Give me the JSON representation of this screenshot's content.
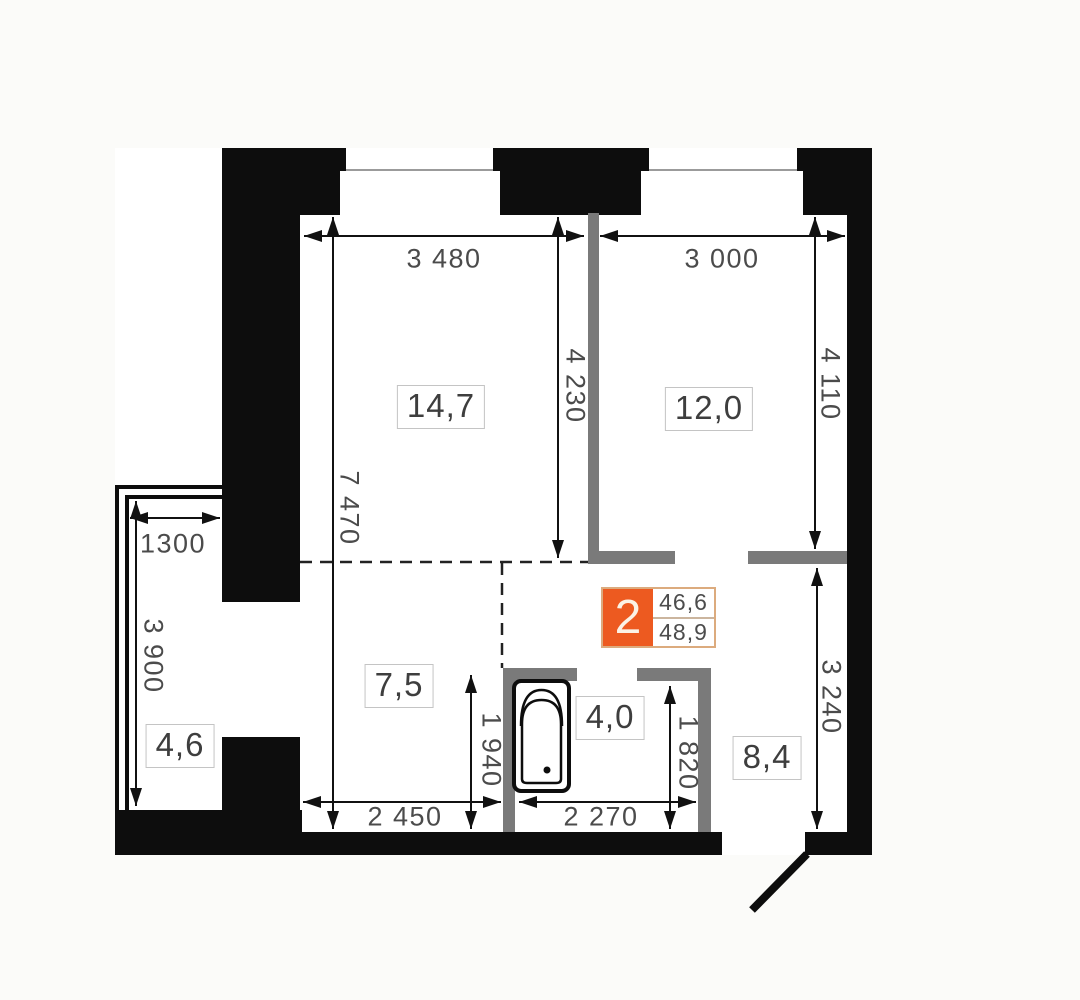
{
  "plan": {
    "badge": {
      "number": "2",
      "value_top": "46,6",
      "value_bottom": "48,9"
    },
    "rooms": {
      "living": "14,7",
      "bedroom": "12,0",
      "hall": "7,5",
      "bathroom": "4,0",
      "corridor": "8,4",
      "balcony": "4,6"
    },
    "dimensions": {
      "living_width": "3 480",
      "bedroom_width": "3 000",
      "living_depth": "4 230",
      "bedroom_depth": "4 110",
      "left_total_depth": "7 470",
      "balcony_width": "1300",
      "balcony_depth": "3 900",
      "hall_width": "2 450",
      "bathroom_width": "2 270",
      "hall_depth": "1 940",
      "bathroom_depth": "1 820",
      "corridor_depth": "3 240"
    },
    "colors": {
      "wall": "#0d0d0d",
      "partition": "#7a7a7a",
      "accent_orange": "#ED5A20",
      "badge_border": "#DCAB7E",
      "dim_text": "#4b4b4b"
    }
  }
}
